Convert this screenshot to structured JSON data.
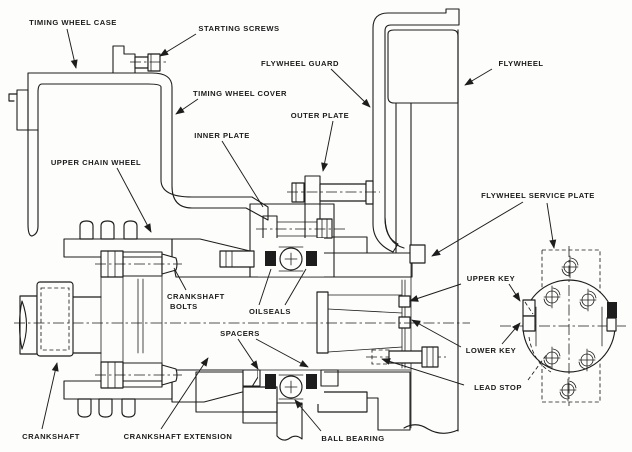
{
  "diagram": {
    "type": "engine-crankshaft-flywheel-cross-section",
    "ink_color": "#1d1d1d",
    "paper_color": "#fdfdfb",
    "labels": {
      "timing_wheel_case": "TIMING WHEEL CASE",
      "starting_screws": "STARTING SCREWS",
      "flywheel_guard": "FLYWHEEL GUARD",
      "flywheel": "FLYWHEEL",
      "timing_wheel_cover": "TIMING WHEEL COVER",
      "outer_plate": "OUTER PLATE",
      "inner_plate": "INNER PLATE",
      "upper_chain_wheel": "UPPER CHAIN WHEEL",
      "flywheel_service_plate": "FLYWHEEL SERVICE PLATE",
      "upper_key": "UPPER KEY",
      "crankshaft_bolts_line1": "CRANKSHAFT",
      "crankshaft_bolts_line2": "BOLTS",
      "oilseals": "OILSEALS",
      "spacers": "SPACERS",
      "lower_key": "LOWER KEY",
      "lead_stop": "LEAD STOP",
      "crankshaft": "CRANKSHAFT",
      "crankshaft_extension": "CRANKSHAFT EXTENSION",
      "ball_bearing": "BALL BEARING"
    }
  }
}
